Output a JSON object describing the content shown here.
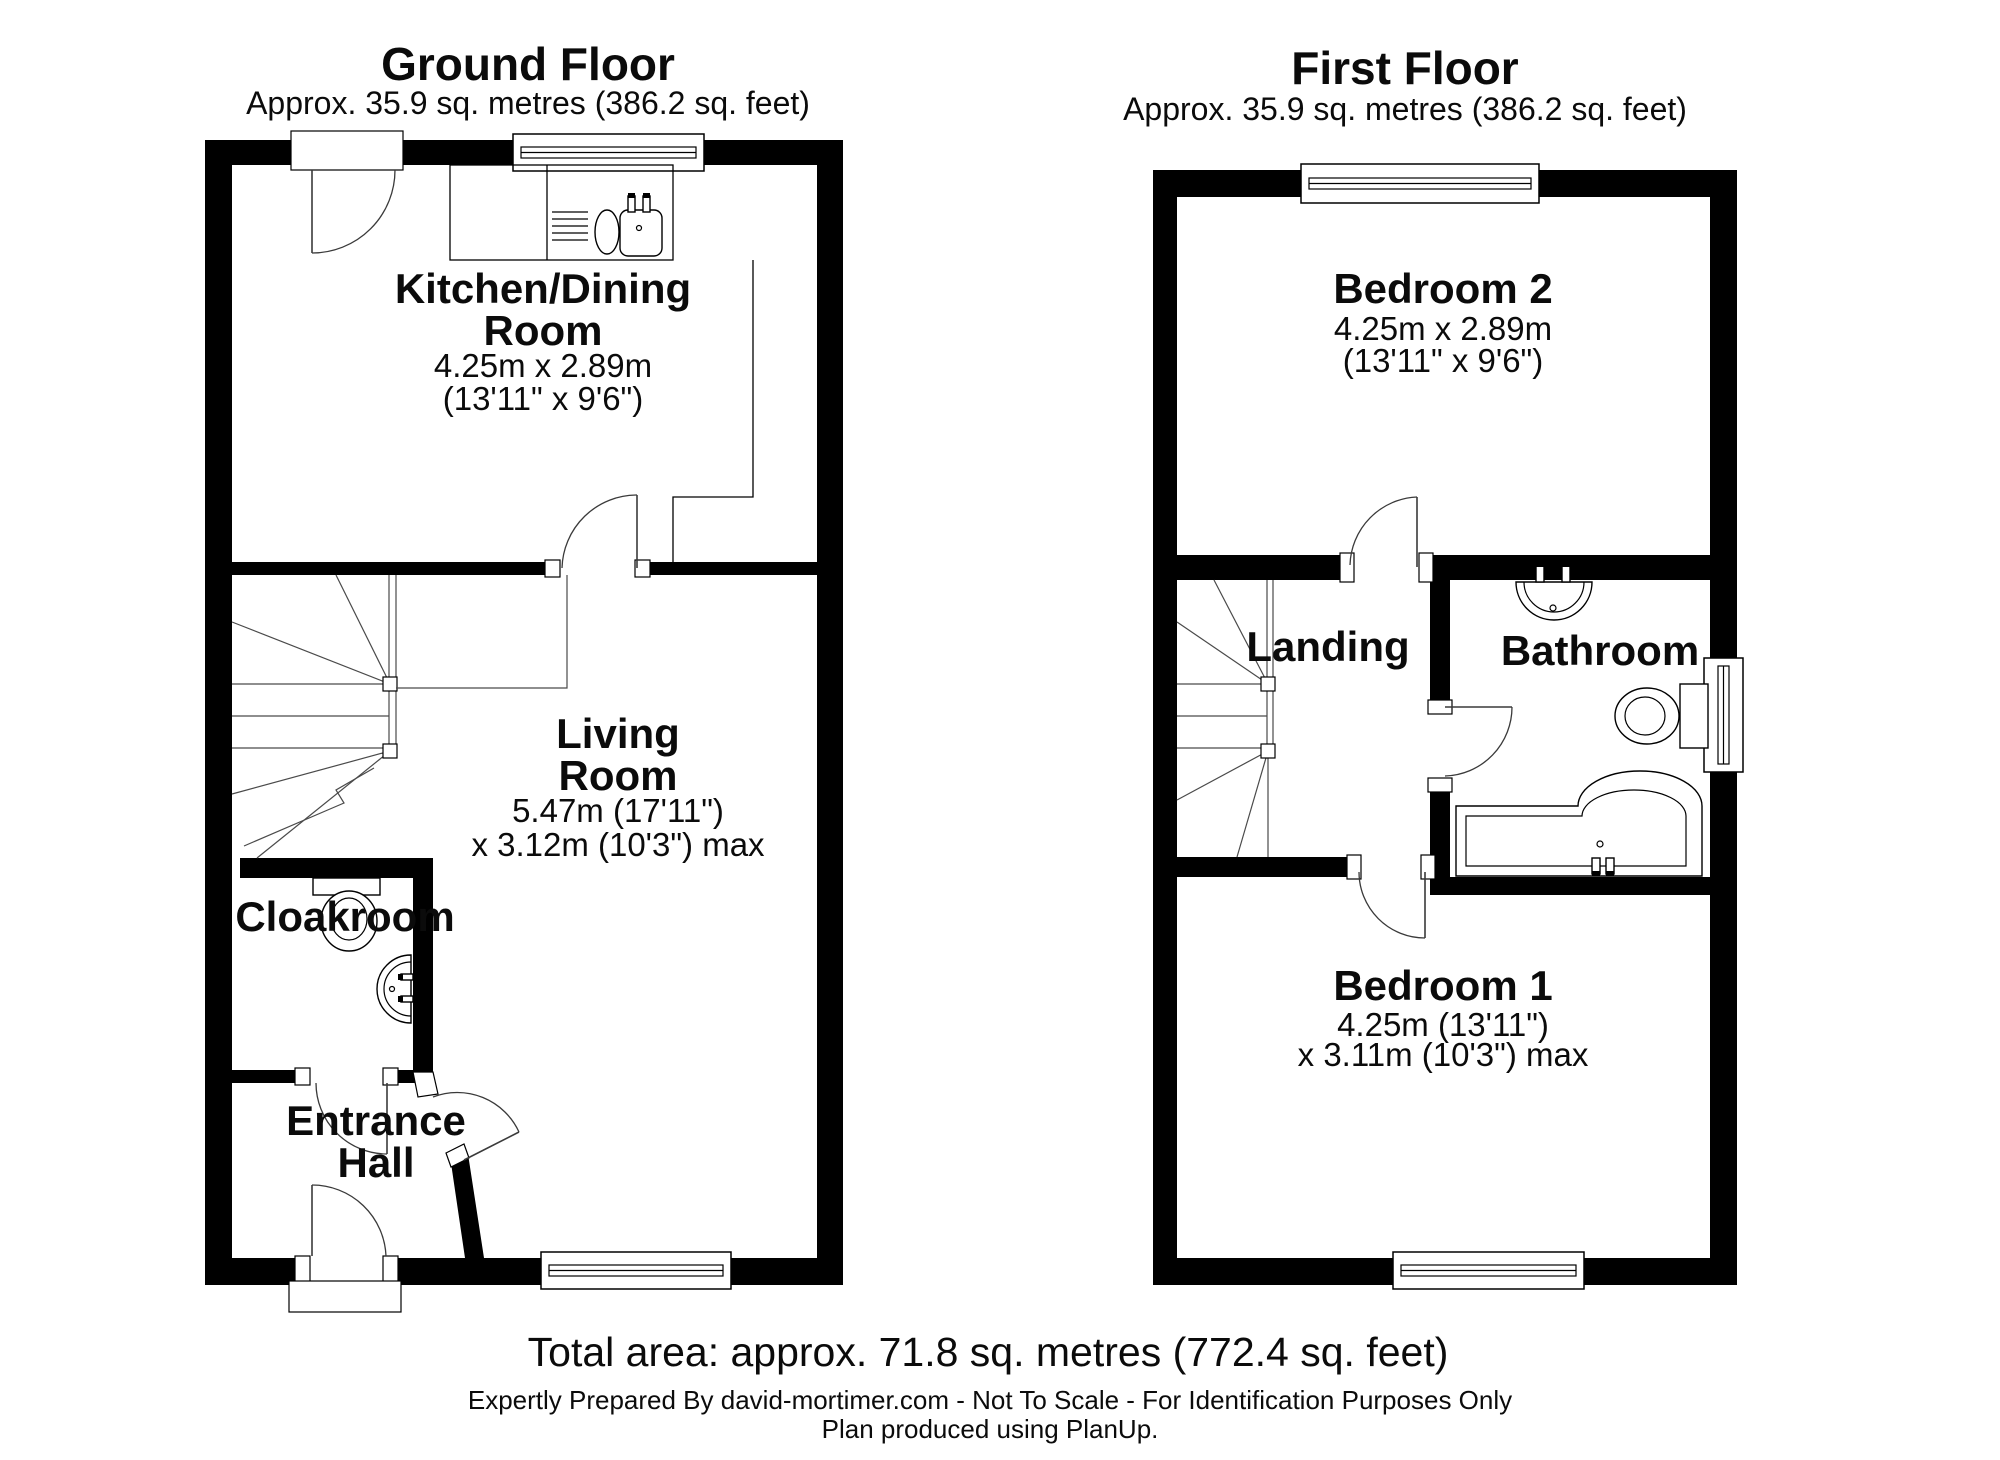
{
  "colors": {
    "wall": "#000000",
    "background": "#ffffff",
    "text": "#0b0b0b"
  },
  "ground_floor": {
    "title": "Ground Floor",
    "subtitle": "Approx. 35.9 sq. metres (386.2 sq. feet)",
    "rooms": {
      "kitchen": {
        "name_line1": "Kitchen/Dining",
        "name_line2": "Room",
        "dim1": "4.25m x 2.89m",
        "dim2": "(13'11\" x 9'6\")"
      },
      "living": {
        "name_line1": "Living",
        "name_line2": "Room",
        "dim1": "5.47m (17'11\")",
        "dim2": "x 3.12m (10'3\") max"
      },
      "cloakroom": {
        "name": "Cloakroom"
      },
      "entrance_hall": {
        "name_line1": "Entrance",
        "name_line2": "Hall"
      }
    }
  },
  "first_floor": {
    "title": "First Floor",
    "subtitle": "Approx. 35.9 sq. metres (386.2 sq. feet)",
    "rooms": {
      "bedroom2": {
        "name": "Bedroom 2",
        "dim1": "4.25m x 2.89m",
        "dim2": "(13'11\" x 9'6\")"
      },
      "landing": {
        "name": "Landing"
      },
      "bathroom": {
        "name": "Bathroom"
      },
      "bedroom1": {
        "name": "Bedroom 1",
        "dim1": "4.25m (13'11\")",
        "dim2": "x 3.11m (10'3\") max"
      }
    }
  },
  "footer": {
    "total_area": "Total area: approx. 71.8 sq. metres (772.4 sq. feet)",
    "disclaimer": "Expertly Prepared By david-mortimer.com - Not To Scale - For Identification Purposes Only",
    "credit": "Plan produced using PlanUp."
  }
}
